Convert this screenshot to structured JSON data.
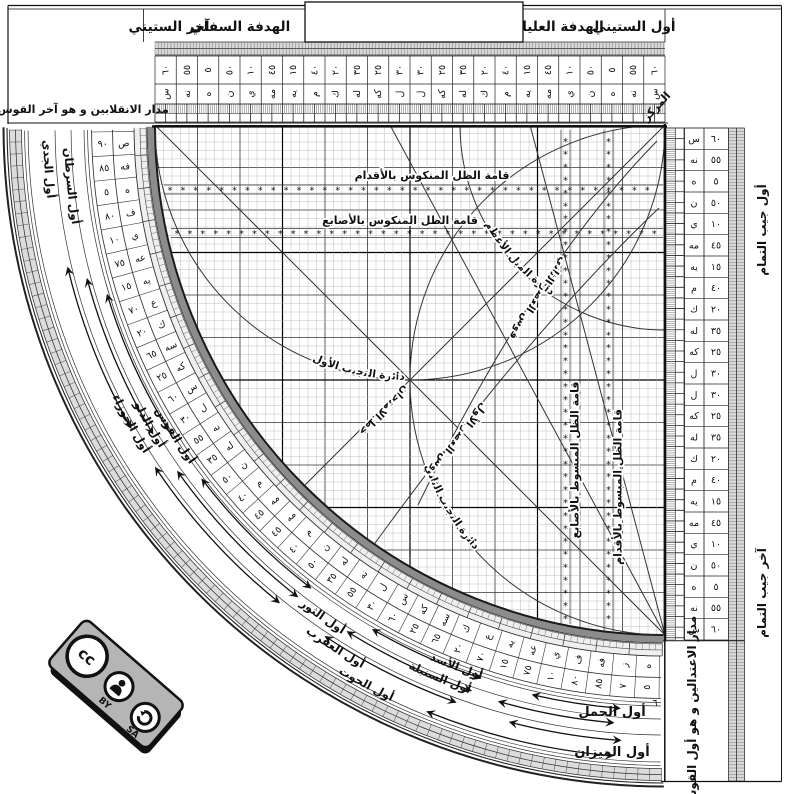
{
  "top_bar": {
    "first_sixty": "أول الستيني",
    "upper_vane": "الهدفة العليا",
    "lower_vane": "الهدفة السفلي",
    "last_sixty": "آخر الستيني"
  },
  "notes": {
    "solstice": "مدار الانقلابين و هو آخر القوس",
    "equinox": "مدار الاعتدالين و هو أول القوس",
    "center": "المركز"
  },
  "cosine_scale": {
    "top": "أول جيب التمام",
    "bottom": "آخر جيب التمام"
  },
  "scales": {
    "sexagesimal_cells": [
      [
        "٦٠",
        "س"
      ],
      [
        "٥٥",
        "نه"
      ],
      [
        "٥",
        "ه"
      ],
      [
        "٥٠",
        "ن"
      ],
      [
        "١٠",
        "ي"
      ],
      [
        "٤٥",
        "مه"
      ],
      [
        "١٥",
        "يه"
      ],
      [
        "٤٠",
        "م"
      ],
      [
        "٢٠",
        "ك"
      ],
      [
        "٣٥",
        "له"
      ],
      [
        "٢٥",
        "كه"
      ],
      [
        "٣٠",
        "ل"
      ],
      [
        "٣٠",
        "ل"
      ],
      [
        "٢٥",
        "كه"
      ],
      [
        "٣٥",
        "له"
      ],
      [
        "٢٠",
        "ك"
      ],
      [
        "٤٠",
        "م"
      ],
      [
        "١٥",
        "يه"
      ],
      [
        "٤٥",
        "مه"
      ],
      [
        "١٠",
        "ي"
      ],
      [
        "٥٠",
        "ن"
      ],
      [
        "٥",
        "ه"
      ],
      [
        "٥٥",
        "نه"
      ],
      [
        "٦٠",
        "س"
      ]
    ],
    "degree_cells": [
      [
        "٩٠",
        "ص"
      ],
      [
        "٨٥",
        "فه"
      ],
      [
        "٥",
        "ه"
      ],
      [
        "٨٠",
        "ف"
      ],
      [
        "١٠",
        "ي"
      ],
      [
        "٧٥",
        "عه"
      ],
      [
        "١٥",
        "يه"
      ],
      [
        "٧٠",
        "ع"
      ],
      [
        "٢٠",
        "ك"
      ],
      [
        "٦٥",
        "سه"
      ],
      [
        "٢٥",
        "كه"
      ],
      [
        "٦٠",
        "س"
      ],
      [
        "٣٠",
        "ل"
      ],
      [
        "٥٥",
        "نه"
      ],
      [
        "٣٥",
        "له"
      ],
      [
        "٥٠",
        "ن"
      ],
      [
        "٤٠",
        "م"
      ],
      [
        "٤٥",
        "مه"
      ],
      [
        "٤٥",
        "مه"
      ],
      [
        "٤٠",
        "م"
      ],
      [
        "٥٠",
        "ن"
      ],
      [
        "٣٥",
        "له"
      ],
      [
        "٥٥",
        "نه"
      ],
      [
        "٣٠",
        "ل"
      ],
      [
        "٦٠",
        "س"
      ],
      [
        "٢٥",
        "كه"
      ],
      [
        "٦٥",
        "سه"
      ],
      [
        "٢٠",
        "ك"
      ],
      [
        "٧٠",
        "ع"
      ],
      [
        "١٥",
        "يه"
      ],
      [
        "٧٥",
        "عه"
      ],
      [
        "١٠",
        "ي"
      ],
      [
        "٨٠",
        "ف"
      ],
      [
        "٨٥",
        "فه"
      ],
      [
        "٧",
        "ز"
      ],
      [
        "٥",
        "ه"
      ]
    ],
    "stray_digit": "٦"
  },
  "grid_labels": {
    "feet_row": "قامة الظل المنكوس بالأقدام",
    "fingers_row": "قامة الظل المنكوس بالأصابع",
    "fingers_col": "قامة الظل المبسوط بالأصابع",
    "feet_col": "قامة الظل المبسوط بالأقدام",
    "obliquity": "دائرة الميل الأعظم",
    "asr_second": "قوس العصر الثاني",
    "asr_first": "قوس العصر الأول",
    "sine_circle_first": "دائرة التجيب الأول",
    "sine_circle_second": "دائرة التجيب الثاني",
    "test_line": "خط الامتحان"
  },
  "zodiac": {
    "band_labels": [
      "أول الجدي",
      "أول السرطان",
      "أول الجوزاء",
      "أول الدلو",
      "أول القوس",
      "أول الثور",
      "أول العقرب",
      "أول السنبلة",
      "أول الأسد",
      "أول الحوت"
    ],
    "aries": "أول الحمل",
    "libra": "أول الميزان"
  },
  "badge": {
    "cc": "cc",
    "by": "BY",
    "sa": "SA"
  }
}
